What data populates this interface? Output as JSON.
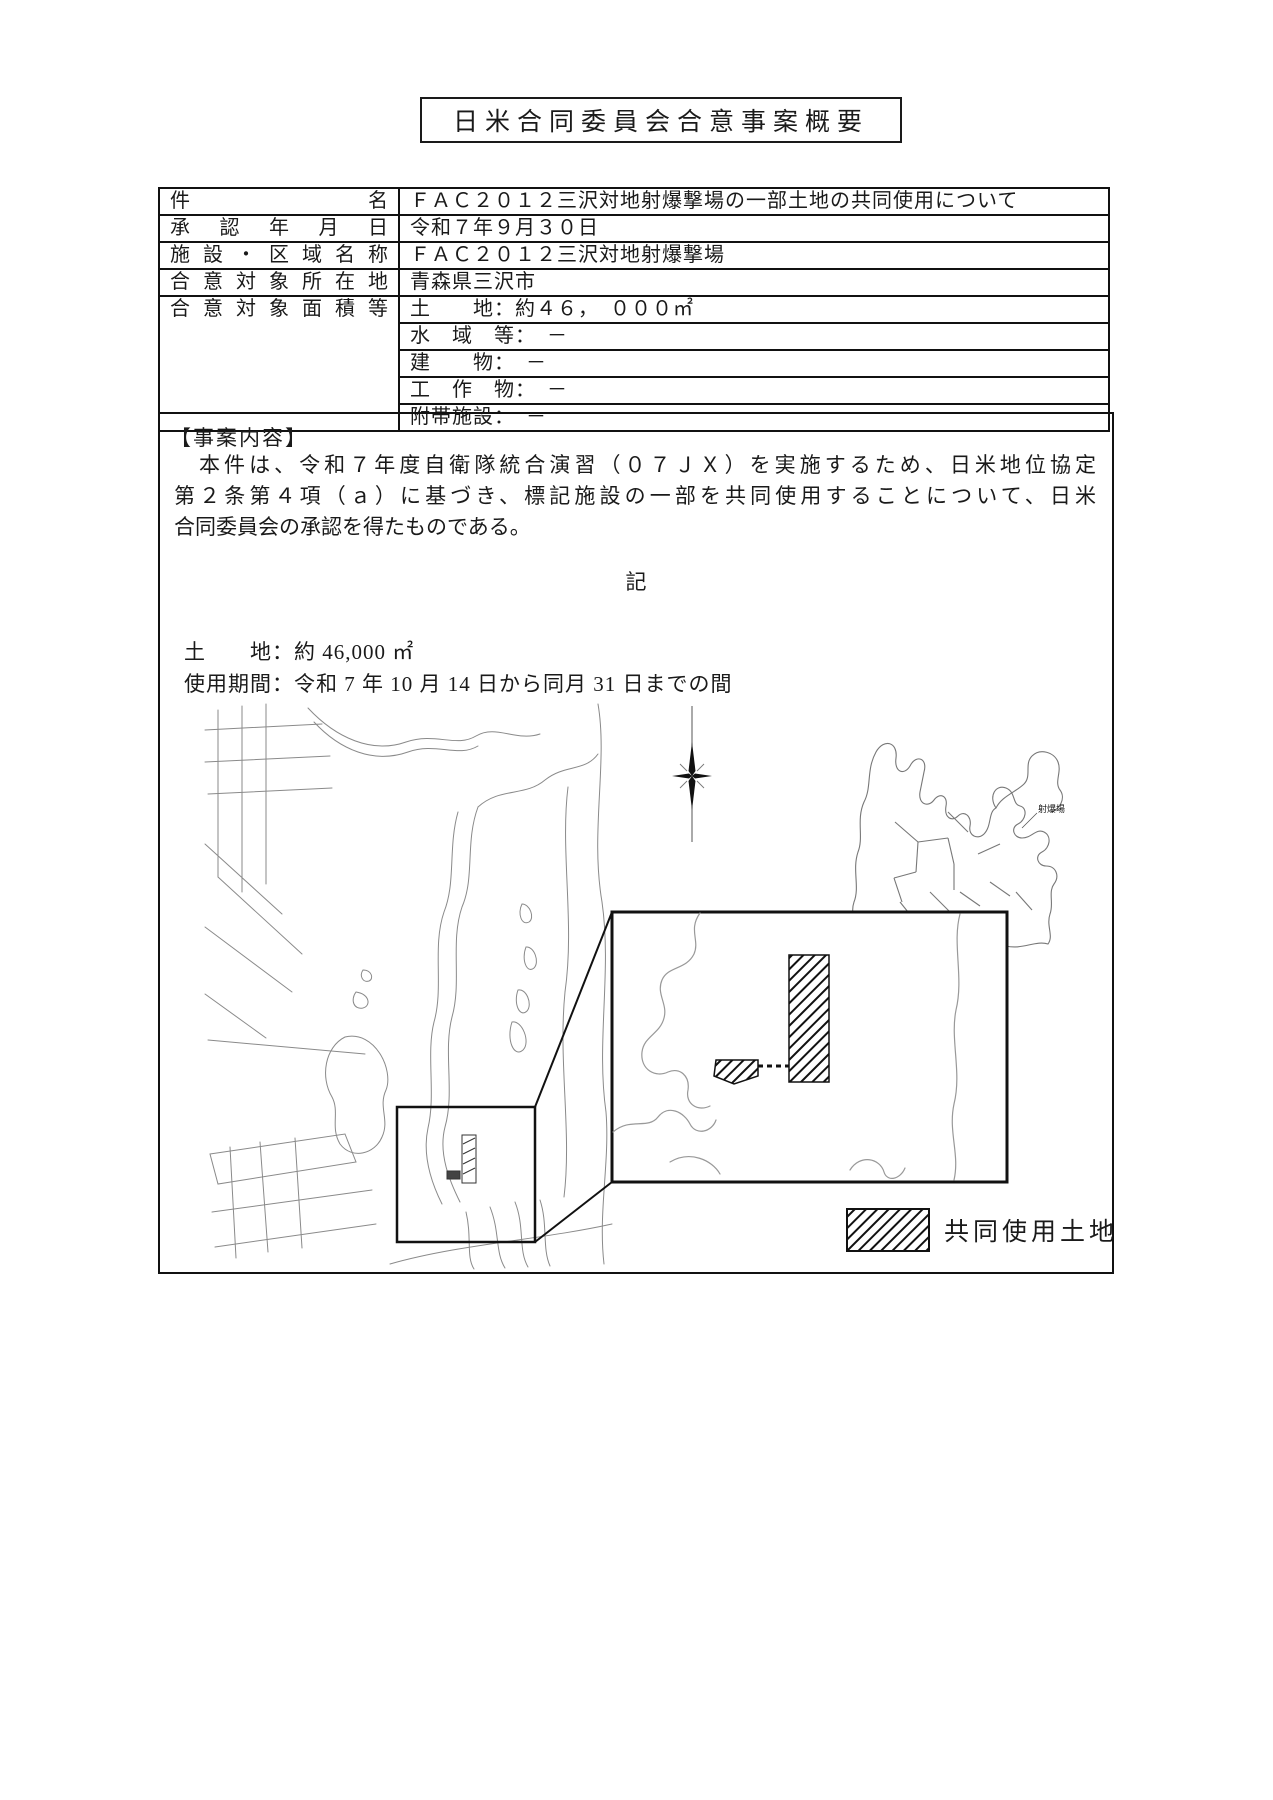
{
  "page": {
    "title": "日米合同委員会合意事案概要"
  },
  "table": {
    "row_name": {
      "label": "件名",
      "value": "ＦＡＣ２０１２三沢対地射爆撃場の一部土地の共同使用について"
    },
    "row_approval": {
      "label": "承認年月日",
      "value": "令和７年９月３０日"
    },
    "row_facility": {
      "label": "施設・区域名称",
      "value": "ＦＡＣ２０１２三沢対地射爆撃場"
    },
    "row_location": {
      "label": "合意対象所在地",
      "value": "青森県三沢市"
    },
    "row_area": {
      "label": "合意対象面積等",
      "items": [
        "土　　地：約４６，　０００㎡",
        "水　域　等：　－",
        "建　　物：　－",
        "工　作　物：　－",
        "附帯施設：　－"
      ]
    }
  },
  "case_content": {
    "heading": "【事案内容】",
    "lines": [
      "　本件は、令和７年度自衛隊統合演習（０７ＪＸ）を実施するため、日米地位協定",
      "第２条第４項（ａ）に基づき、標記施設の一部を共同使用することについて、日米",
      "合同委員会の承認を得たものである。"
    ],
    "ki": "記",
    "land_line": "土　　地：約 46,000 ㎡",
    "period_line": "使用期間：令和 7 年 10 月 14 日から同月 31 日までの間"
  },
  "map": {
    "aomori_label": "射爆場",
    "legend_label": "共同使用土地"
  }
}
